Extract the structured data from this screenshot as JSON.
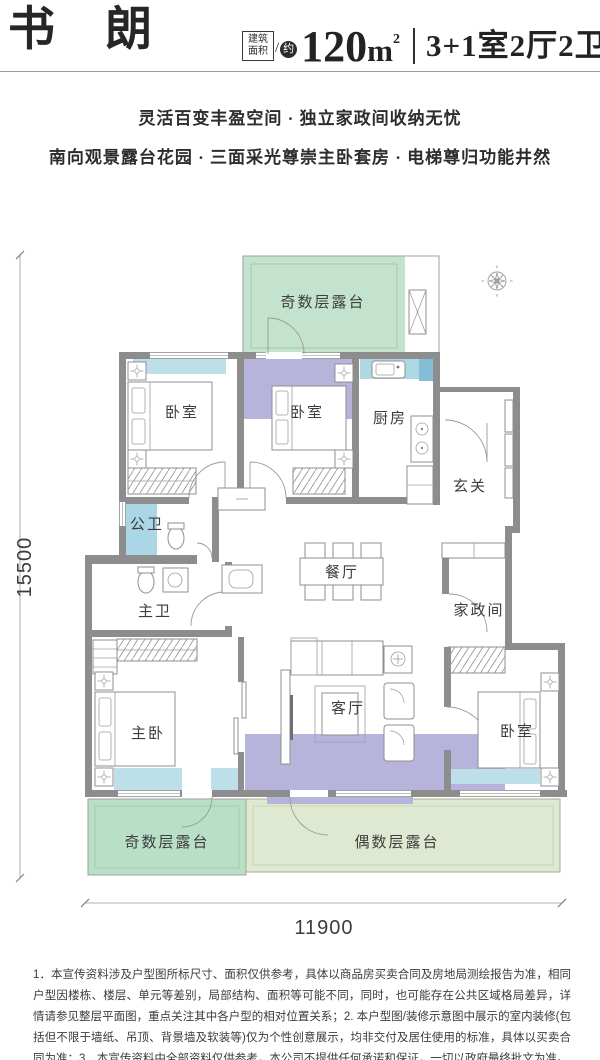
{
  "header": {
    "title": "书朗",
    "area_label_line1": "建筑",
    "area_label_line2": "面积",
    "area_slash": "/",
    "area_approx": "约",
    "area_number": "120",
    "area_unit": "m",
    "area_sup": "2",
    "spec": "3+1室2厅2卫"
  },
  "subtitles": [
    "灵活百变丰盈空间 · 独立家政间收纳无忧",
    "南向观景露台花园 · 三面采光尊崇主卧套房 · 电梯尊归功能井然"
  ],
  "plan": {
    "rooms": {
      "terrace_top": "奇数层露台",
      "bedroom_left": "卧室",
      "bedroom_mid": "卧室",
      "kitchen": "厨房",
      "entry": "玄关",
      "bath_public": "公卫",
      "dining": "餐厅",
      "bath_master": "主卫",
      "utility": "家政间",
      "master_bedroom": "主卧",
      "living": "客厅",
      "bedroom_right": "卧室",
      "terrace_odd": "奇数层露台",
      "terrace_even": "偶数层露台"
    },
    "dimensions": {
      "height_mm": "15500",
      "width_mm": "11900"
    },
    "colors": {
      "wall": "#8d8d8d",
      "terrace_green_top": "#c4e3ce",
      "terrace_green_bottom": "#badfc7",
      "terrace_pale": "#dfe9d1",
      "tint_purple": "#b6b4da",
      "tint_blue": "#bcdfe9",
      "tint_blue_bath": "#abd6e6",
      "tint_blue_counter": "#aed8e4",
      "tint_blue_dark": "#85bcd6"
    }
  },
  "disclaimer": "1．本宣传资料涉及户型图所标尺寸、面积仅供参考，具体以商品房买卖合同及房地局测绘报告为准，相同户型因楼栋、楼层、单元等差别，局部结构、面积等可能不同，同时，也可能存在公共区域格局差异，详情请参见整层平面图，重点关注其中各户型的相对位置关系；2. 本户型图/装修示意图中展示的室内装修(包括但不限于墙纸、吊顶、背景墙及软装等)仅为个性创意展示，均非交付及居住使用的标准，具体以买卖合同为准；3．本宣传资料中全部资料仅供参考，本公司不提供任何承诺和保证，一切以政府最终批文为准。"
}
